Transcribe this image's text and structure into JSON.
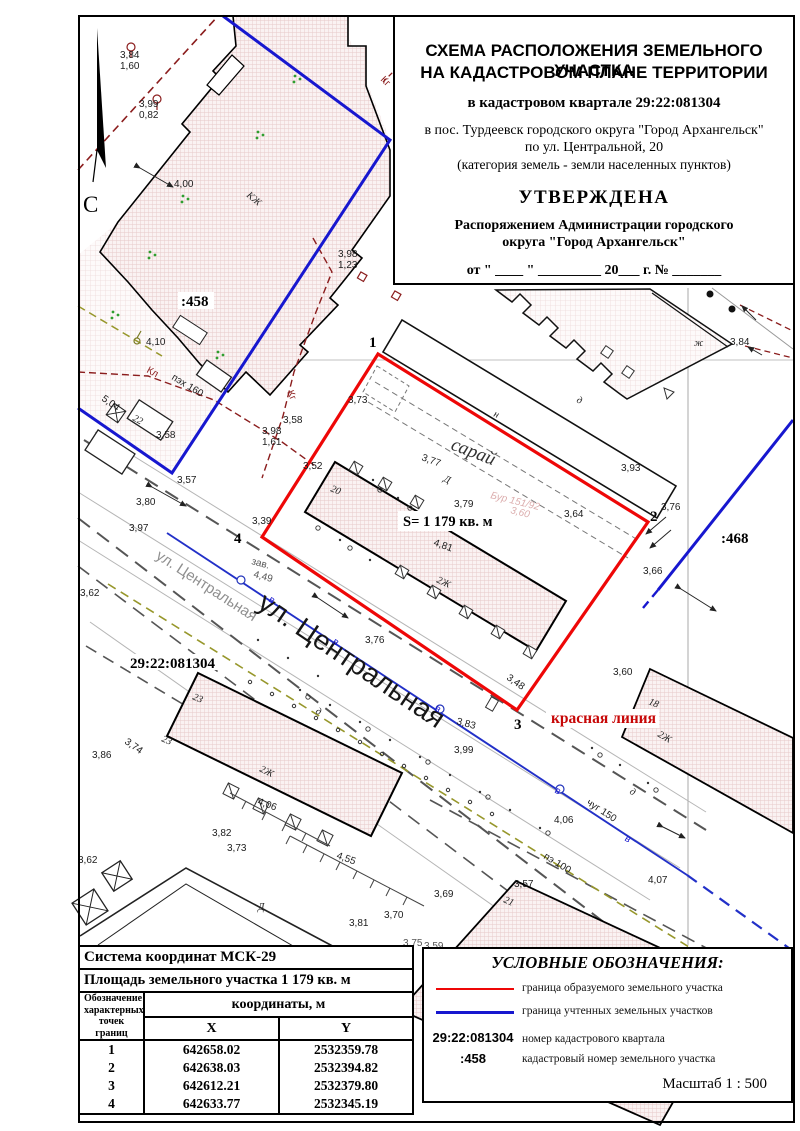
{
  "title_block": {
    "line1": "СХЕМА РАСПОЛОЖЕНИЯ ЗЕМЕЛЬНОГО УЧАСТКА",
    "line2": "НА КАДАСТРОВОМ ПЛАНЕ ТЕРРИТОРИИ",
    "quarter": "в кадастровом квартале 29:22:081304",
    "address1": "в пос. Турдеевск городского округа \"Город Архангельск\"",
    "address2": "по ул. Центральной, 20",
    "category": "(категория земель - земли населенных пунктов)",
    "approved": "УТВЕРЖДЕНА",
    "approved_by1": "Распоряжением Администрации городского",
    "approved_by2": "округа \"Город Архангельск\"",
    "date_line": "от \" ____ \"  _________  20___  г. №  _______"
  },
  "coords_table": {
    "system": "Система координат МСК-29",
    "area": "Площадь земельного участка 1 179 кв. м",
    "point_col": [
      "Обозначение",
      "характерных",
      "точек границ"
    ],
    "coords_header": "координаты, м",
    "x_header": "X",
    "y_header": "Y",
    "rows": [
      {
        "n": "1",
        "x": "642658.02",
        "y": "2532359.78"
      },
      {
        "n": "2",
        "x": "642638.03",
        "y": "2532394.82"
      },
      {
        "n": "3",
        "x": "642612.21",
        "y": "2532379.80"
      },
      {
        "n": "4",
        "x": "642633.77",
        "y": "2532345.19"
      }
    ]
  },
  "legend": {
    "title": "УСЛОВНЫЕ ОБОЗНАЧЕНИЯ:",
    "items": [
      {
        "code": "",
        "text": "граница образуемого земельного участка"
      },
      {
        "code": "",
        "text": "граница учтенных земельных участков"
      },
      {
        "code": "29:22:081304",
        "text": "номер кадастрового квартала"
      },
      {
        "code": ":458",
        "text": "кадастровый номер земельного участка"
      }
    ],
    "scale": "Масштаб  1 : 500"
  },
  "colors": {
    "formed_parcel_boundary": "#ee0707",
    "registered_parcel_boundary": "#1717cf",
    "red_line_label": "#c70707",
    "utility_maroon": "#8b1d1d",
    "utility_olive": "#97972b"
  },
  "map": {
    "labels": [
      {
        "t": "С"
      },
      {
        "t": "3,84"
      },
      {
        "t": "1,60"
      },
      {
        "t": "3,99"
      },
      {
        "t": "0,82"
      },
      {
        "t": "4,00"
      },
      {
        "t": "КЖ"
      },
      {
        "t": "3,98"
      },
      {
        "t": "1,23"
      },
      {
        "t": ":458"
      },
      {
        "t": "4,10"
      },
      {
        "t": "5,04"
      },
      {
        "t": "22"
      },
      {
        "t": "3,58"
      },
      {
        "t": "Кл"
      },
      {
        "t": "пэх 160"
      },
      {
        "t": "Кг"
      },
      {
        "t": "3,98"
      },
      {
        "t": "1,61"
      },
      {
        "t": "3,58"
      },
      {
        "t": "3,73"
      },
      {
        "t": "3,52"
      },
      {
        "t": "3,57"
      },
      {
        "t": "3,80"
      },
      {
        "t": "3,97"
      },
      {
        "t": "3,62"
      },
      {
        "t": "1"
      },
      {
        "t": "2"
      },
      {
        "t": "3"
      },
      {
        "t": "4"
      },
      {
        "t": "3,39"
      },
      {
        "t": "сарай"
      },
      {
        "t": "н"
      },
      {
        "t": "д"
      },
      {
        "t": "Д"
      },
      {
        "t": "3,77"
      },
      {
        "t": "3,79"
      },
      {
        "t": "Бур 151/92"
      },
      {
        "t": "3,60"
      },
      {
        "t": "3,64"
      },
      {
        "t": "3,93"
      },
      {
        "t": "20"
      },
      {
        "t": "S= 1 179 кв. м"
      },
      {
        "t": "2Ж"
      },
      {
        "t": "4,81"
      },
      {
        "t": "3,66"
      },
      {
        "t": "3,76"
      },
      {
        "t": ":468"
      },
      {
        "t": "ж"
      },
      {
        "t": "3,84"
      },
      {
        "t": "ул. Центральная"
      },
      {
        "t": "ул. Центральная"
      },
      {
        "t": "29:22:081304"
      },
      {
        "t": "зав."
      },
      {
        "t": "4,49"
      },
      {
        "t": "в"
      },
      {
        "t": "в"
      },
      {
        "t": "в"
      },
      {
        "t": "в"
      },
      {
        "t": "в"
      },
      {
        "t": "3,76"
      },
      {
        "t": "красная линия"
      },
      {
        "t": "3,48"
      },
      {
        "t": "3,83"
      },
      {
        "t": "3,99"
      },
      {
        "t": "18"
      },
      {
        "t": "2Ж"
      },
      {
        "t": "3,60"
      },
      {
        "t": "чуг 150"
      },
      {
        "t": "4,06"
      },
      {
        "t": "д"
      },
      {
        "t": "23"
      },
      {
        "t": "23"
      },
      {
        "t": "2Ж"
      },
      {
        "t": "3,74"
      },
      {
        "t": "3,86"
      },
      {
        "t": "3,62"
      },
      {
        "t": "3,82"
      },
      {
        "t": "3,73"
      },
      {
        "t": "4,06"
      },
      {
        "t": "4,55"
      },
      {
        "t": "3,81"
      },
      {
        "t": "Д"
      },
      {
        "t": "д"
      },
      {
        "t": "21"
      },
      {
        "t": "пэ 100"
      },
      {
        "t": "3,57"
      },
      {
        "t": "4,07"
      },
      {
        "t": "3,69"
      },
      {
        "t": "3,70"
      },
      {
        "t": "3,75"
      },
      {
        "t": "3,59"
      },
      {
        "t": "Кг"
      }
    ]
  }
}
